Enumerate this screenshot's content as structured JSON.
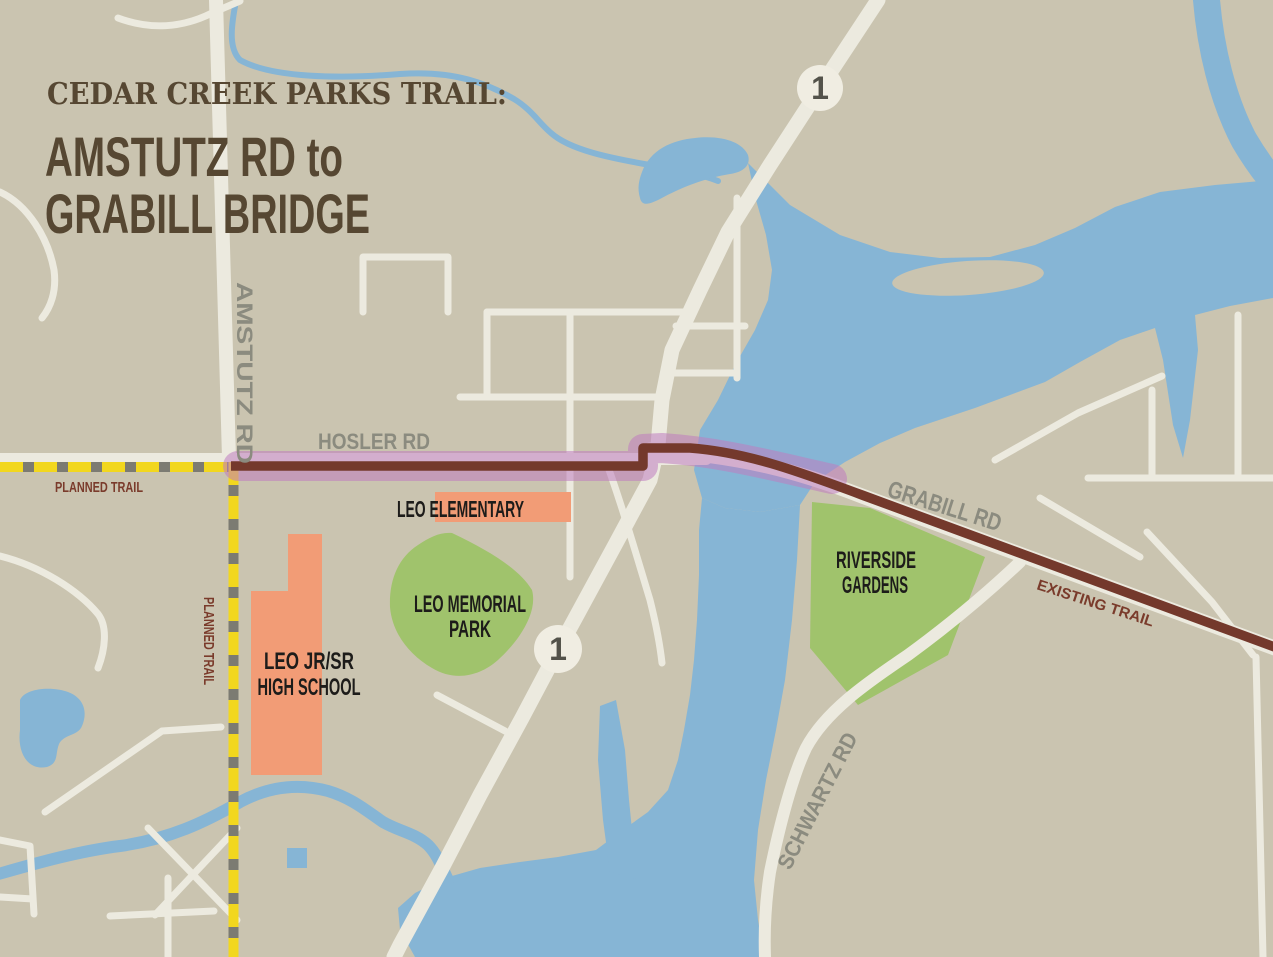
{
  "map": {
    "title": {
      "kicker": "CEDAR CREEK PARKS TRAIL:",
      "line1": "AMSTUTZ RD to",
      "line2": "GRABILL BRIDGE"
    },
    "road_labels": {
      "amstutz": "AMSTUTZ RD",
      "hosler": "HOSLER RD",
      "grabill": "GRABILL RD",
      "schwartz": "SCHWARTZ RD"
    },
    "trail_labels": {
      "planned": "PLANNED TRAIL",
      "existing": "EXISTING TRAIL"
    },
    "place_labels": {
      "leo_elementary": "LEO ELEMENTARY",
      "leo_memorial_line1": "LEO MEMORIAL",
      "leo_memorial_line2": "PARK",
      "high_school_line1": "LEO JR/SR",
      "high_school_line2": "HIGH SCHOOL",
      "riverside_line1": "RIVERSIDE",
      "riverside_line2": "GARDENS"
    },
    "highway_shield": {
      "number": "1"
    },
    "colors": {
      "background": "#cac4b0",
      "water": "#86b5d5",
      "road": "#eceadf",
      "park_green": "#a0c36c",
      "building_orange": "#f29c76",
      "trail_brown": "#74392c",
      "trail_highlight_purple": "#bf7cc0",
      "planned_trail_yellow": "#f2d71e",
      "planned_trail_gray": "#7c7b72",
      "title_brown": "#564732",
      "road_label_gray": "#8b8b7f",
      "trail_label_brown": "#7a3b2b",
      "place_label_black": "#1d1c1a",
      "shield_fill": "#f0ede2",
      "shield_text": "#53524a"
    }
  }
}
